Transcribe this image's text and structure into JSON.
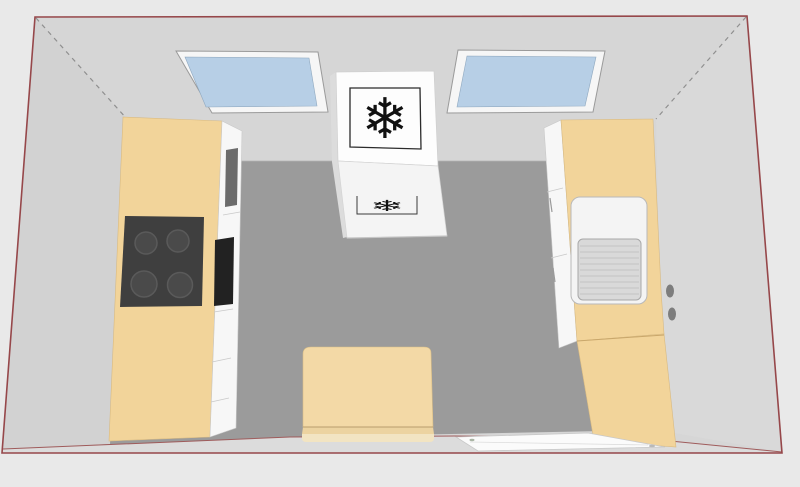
{
  "scene": {
    "type": "kitchen-3d-plan-view",
    "freezer": {
      "icon": "snowflake-icon",
      "icon_glyph": "❄"
    },
    "objects": [
      {
        "name": "skylight-window-left"
      },
      {
        "name": "skylight-window-right"
      },
      {
        "name": "freezer-cabinet"
      },
      {
        "name": "left-counter",
        "appliances": [
          "cooktop-4-burners",
          "oven"
        ]
      },
      {
        "name": "right-counter",
        "appliances": [
          "sink-with-drainer"
        ]
      },
      {
        "name": "dining-table"
      },
      {
        "name": "work-table"
      },
      {
        "name": "wall-sockets",
        "count": 2
      }
    ],
    "burner_count": 4
  },
  "palette": {
    "background": "#e9e9e9",
    "outline": "#96474a",
    "inner_line": "#9f5b5b",
    "back_wall": "#d6d6d6",
    "left_wall": "#d2d2d2",
    "right_wall": "#d9d9d9",
    "floor": "#9b9b9b",
    "near_strip": "#dcdcdc",
    "dashed_edge": "#8f8f8f",
    "window_glass": "#b7cfe6",
    "window_frame": "#f6f6f6",
    "wood": "#f2d49a",
    "wood_table": "#f3d9a6",
    "wood_table_mid": "#ecd3a0",
    "wood_table_band": "#f2e4c2",
    "cooktop": "#3f3f3f",
    "burner": "#4a4a4a",
    "burner_ring": "#5a5a5a",
    "cabinet_white": "#f7f7f7",
    "slot_dark": "#6b6b6b",
    "oven_black": "#222222",
    "fridge_white": "#fdfdfd",
    "fridge_front": "#f4f4f4",
    "fridge_side": "#dcdcdc",
    "sink_outer": "#f4f4f4",
    "sink_basin": "#d9d9d9",
    "sink_stripe": "#c4c4c4",
    "socket": "#7d7d7d",
    "worktable_white": "#fbfbfb",
    "snowflake": "#111111"
  }
}
